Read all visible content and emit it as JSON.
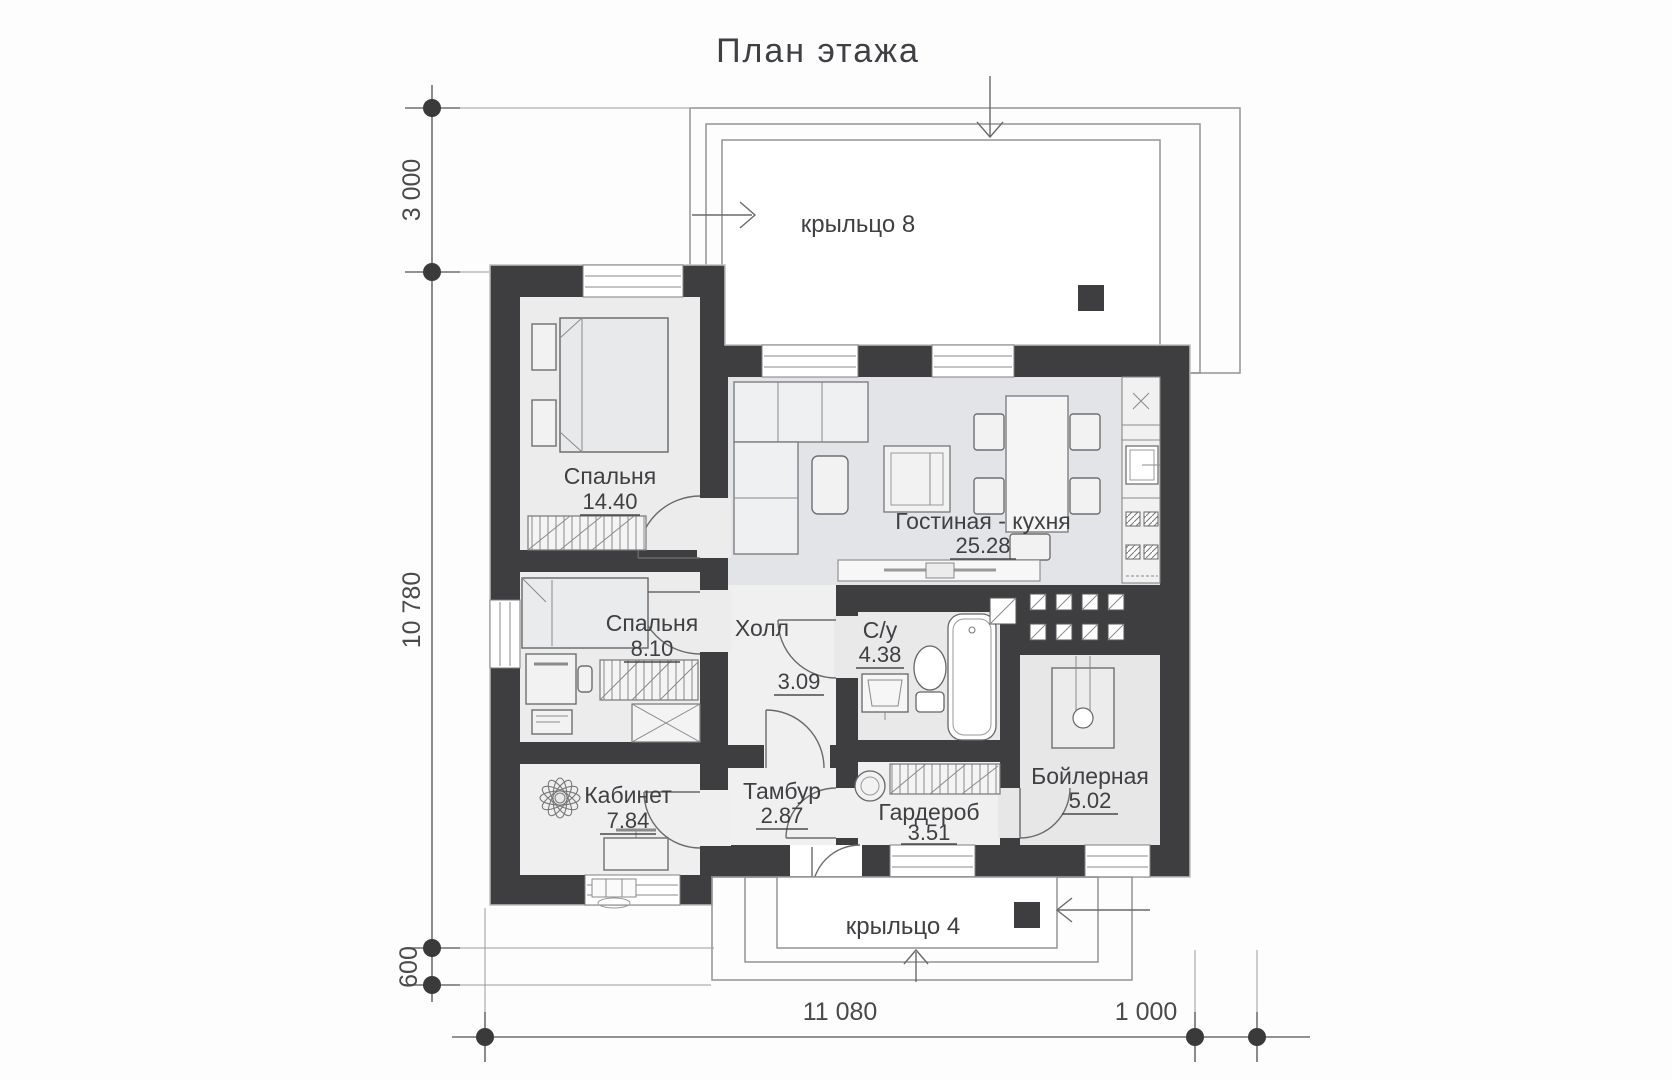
{
  "title": "План этажа",
  "porches": {
    "top": {
      "label": "крыльцо 8"
    },
    "bottom": {
      "label": "крыльцо 4"
    }
  },
  "rooms": {
    "bedroom1": {
      "name": "Спальня",
      "area": "14.40"
    },
    "bedroom2": {
      "name": "Спальня",
      "area": "8.10"
    },
    "office": {
      "name": "Кабинет",
      "area": "7.84"
    },
    "hall": {
      "name": "Холл",
      "area": "3.09"
    },
    "tambour": {
      "name": "Тамбур",
      "area": "2.87"
    },
    "wardrobe": {
      "name": "Гардероб",
      "area": "3.51"
    },
    "bathroom": {
      "name": "С/у",
      "area": "4.38"
    },
    "boiler": {
      "name": "Бойлерная",
      "area": "5.02"
    },
    "living": {
      "name": "Гостиная - кухня",
      "area": "25.28"
    }
  },
  "dimensions": {
    "left_top": "3 000",
    "left_middle": "10 780",
    "left_bottom": "600",
    "bottom_width": "11 080",
    "bottom_right": "1 000"
  },
  "colors": {
    "wall": "#3e3e40",
    "living_floor": "#e2e4e7",
    "room_floor": "#ececec",
    "background": "#fdfdfd"
  },
  "furniture_icons": [
    "double-bed-icon",
    "nightstand-icon",
    "single-bed-icon",
    "desk-icon",
    "printer-icon",
    "wardrobe-hatch-icon",
    "crossed-storage-icon",
    "plant-icon",
    "office-chair-icon",
    "dresser-icon",
    "corner-sofa-icon",
    "side-table-icon",
    "coffee-table-icon",
    "tv-console-icon",
    "dining-table-icon",
    "chair-icon",
    "kitchen-sink-icon",
    "fridge-icon",
    "stove-icon",
    "washbasin-icon",
    "toilet-icon",
    "bathtub-icon",
    "washing-machine-icon",
    "boiler-icon",
    "flue-icon",
    "door-arc-icon",
    "window-icon",
    "entry-arrow-icon",
    "column-icon"
  ]
}
